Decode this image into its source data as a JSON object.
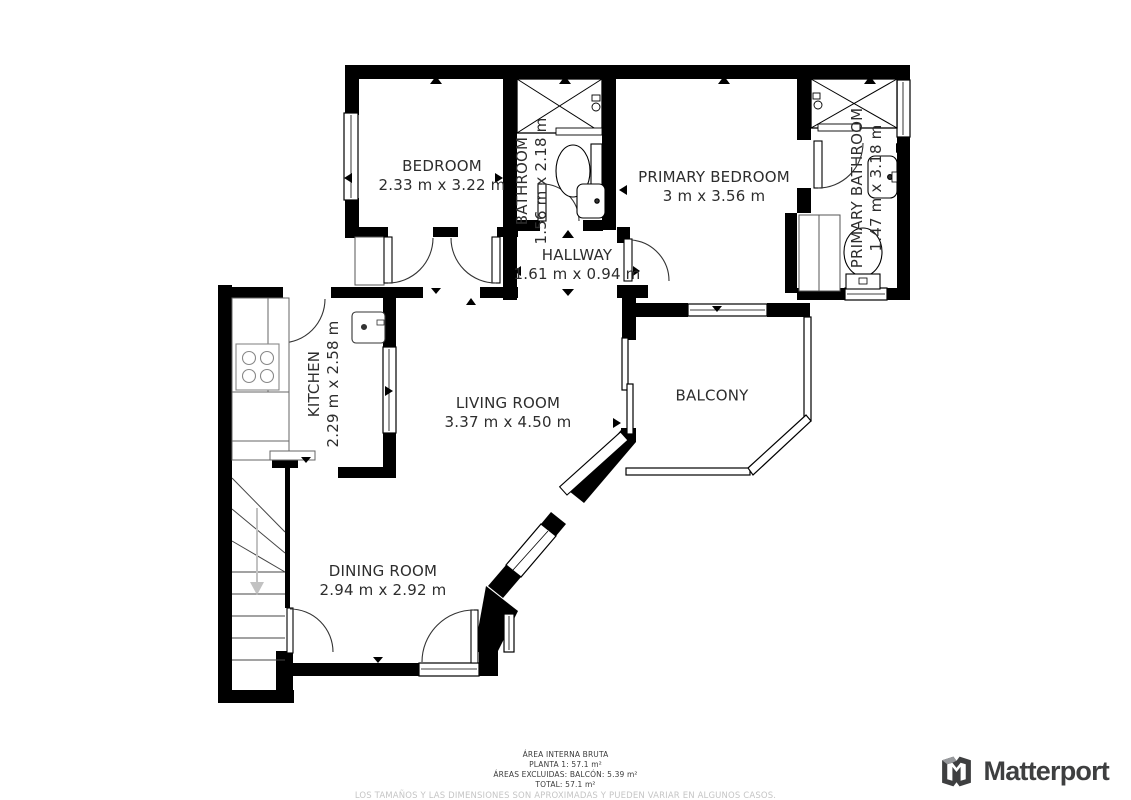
{
  "rooms": [
    {
      "id": "bedroom",
      "name": "BEDROOM",
      "dims": "2.33 m x 3.22 m"
    },
    {
      "id": "bathroom",
      "name": "BATHROOM",
      "dims": "1.56 m x 2.18 m"
    },
    {
      "id": "primary-bedroom",
      "name": "PRIMARY BEDROOM",
      "dims": "3 m x 3.56 m"
    },
    {
      "id": "primary-bathroom",
      "name": "PRIMARY BATHROOM",
      "dims": "1.47 m x 3.18 m"
    },
    {
      "id": "hallway",
      "name": "HALLWAY",
      "dims": "1.61 m x 0.94 m"
    },
    {
      "id": "kitchen",
      "name": "KITCHEN",
      "dims": "2.29 m x 2.58 m"
    },
    {
      "id": "living-room",
      "name": "LIVING ROOM",
      "dims": "3.37 m x 4.50 m"
    },
    {
      "id": "balcony",
      "name": "BALCONY",
      "dims": ""
    },
    {
      "id": "dining-room",
      "name": "DINING ROOM",
      "dims": "2.94 m x 2.92 m"
    }
  ],
  "footer": {
    "line1": "ÁREA INTERNA BRUTA",
    "line2": "PLANTA 1: 57.1 m²",
    "line3": "ÁREAS EXCLUIDAS: BALCÓN: 5.39 m²",
    "line4": "TOTAL: 57.1 m²",
    "disclaimer": "LOS TAMAÑOS Y LAS DIMENSIONES SON APROXIMADAS Y PUEDEN VARIAR EN ALGUNOS CASOS."
  },
  "branding": {
    "logo_text": "Matterport"
  },
  "colors": {
    "wall": "#000000",
    "label": "#2d2d2d",
    "disclaimer": "#c5c5c5",
    "logo": "#3e3f40",
    "stair_arrow": "#c2c2c2"
  }
}
